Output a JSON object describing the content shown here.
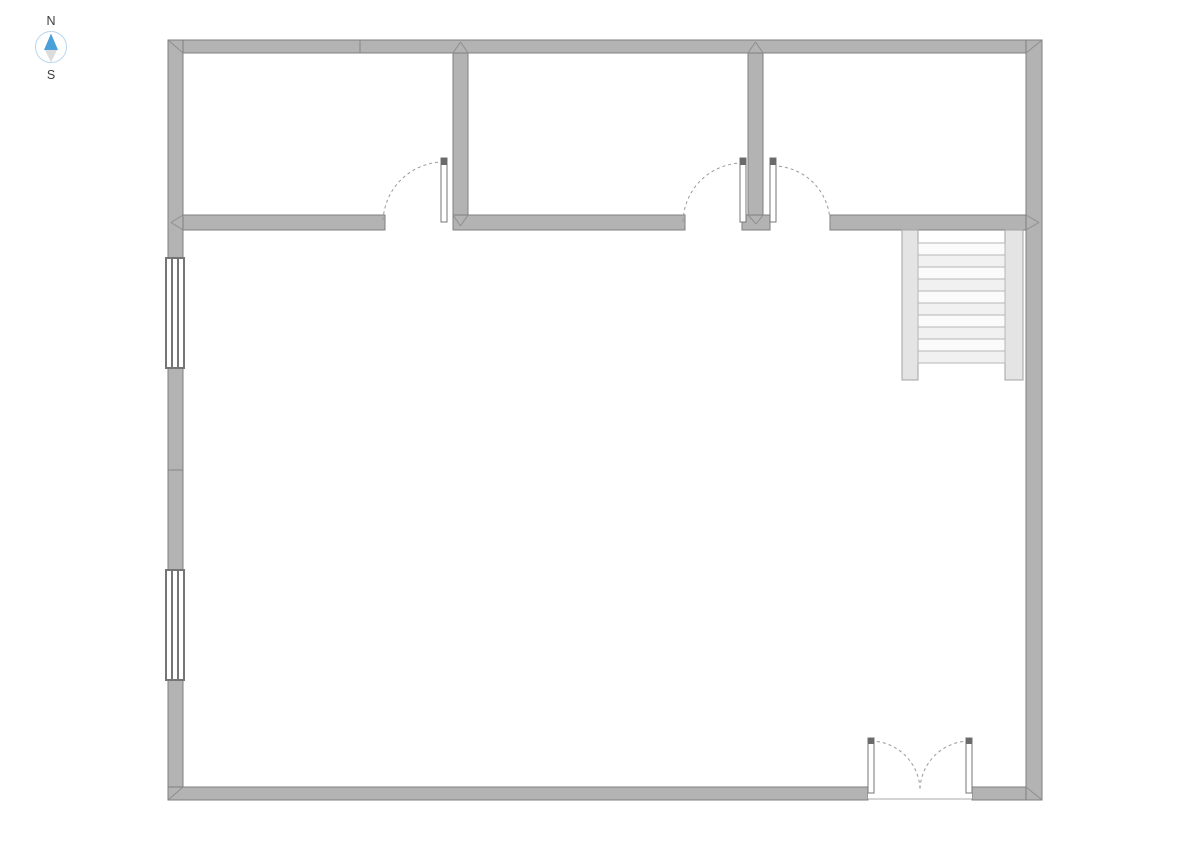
{
  "app": {
    "background_color": "#ffffff"
  },
  "compass": {
    "north_label": "N",
    "south_label": "S",
    "cx": 51,
    "cy": 47,
    "radius": 15.5,
    "ring_color": "#b7d7ec",
    "ring_fill": "#ffffff",
    "north_needle_color": "#4aa0d8",
    "south_needle_color": "#dcdcdc",
    "label_color": "#3c3c3c"
  },
  "floor_plan": {
    "canvas": {
      "width": 1191,
      "height": 842
    },
    "colors": {
      "wall_fill": "#b3b3b3",
      "wall_stroke": "#7f7f7f",
      "miter_stroke": "#8e8e8e",
      "door_leaf_fill": "#ffffff",
      "door_leaf_stroke": "#767676",
      "door_leaf_cap": "#6a6a6a",
      "door_arc": "#9a9a9a",
      "window_fill": "#ffffff",
      "window_stroke": "#757575",
      "stair_stringer_fill": "#e4e4e4",
      "stair_stringer_stroke": "#a3a3a3",
      "stair_tread_fill_a": "#fbfbfb",
      "stair_tread_fill_b": "#f1f1f1",
      "stair_tread_stroke": "#b6b6b6",
      "threshold_fill": "#ffffff",
      "threshold_stroke": "#ababab"
    },
    "walls": [
      {
        "name": "outer-wall-top",
        "x": 168,
        "y": 40,
        "w": 874,
        "h": 13
      },
      {
        "name": "outer-wall-left",
        "x": 168,
        "y": 40,
        "w": 15,
        "h": 760
      },
      {
        "name": "outer-wall-bottom-left",
        "x": 168,
        "y": 787,
        "w": 700,
        "h": 13
      },
      {
        "name": "outer-wall-bottom-right",
        "x": 972,
        "y": 787,
        "w": 70,
        "h": 13
      },
      {
        "name": "outer-wall-right",
        "x": 1026,
        "y": 40,
        "w": 16,
        "h": 760
      },
      {
        "name": "interior-wall-vertical-1",
        "x": 453,
        "y": 53,
        "w": 15,
        "h": 177
      },
      {
        "name": "interior-wall-vertical-2",
        "x": 748,
        "y": 53,
        "w": 15,
        "h": 162
      },
      {
        "name": "interior-wall-pier",
        "x": 742,
        "y": 215,
        "w": 28,
        "h": 15
      },
      {
        "name": "interior-wall-horizontal-left",
        "x": 183,
        "y": 215,
        "w": 202,
        "h": 15
      },
      {
        "name": "interior-wall-horizontal-mid",
        "x": 453,
        "y": 215,
        "w": 232,
        "h": 15
      },
      {
        "name": "interior-wall-horizontal-right",
        "x": 830,
        "y": 215,
        "w": 196,
        "h": 15
      }
    ],
    "miters": [
      [
        168,
        40,
        183,
        53
      ],
      [
        1042,
        40,
        1026,
        53
      ],
      [
        168,
        800,
        183,
        787
      ],
      [
        1042,
        800,
        1026,
        787
      ],
      [
        453,
        53,
        460.5,
        42
      ],
      [
        468,
        53,
        460.5,
        42
      ],
      [
        748,
        53,
        755.5,
        42
      ],
      [
        763,
        53,
        755.5,
        42
      ],
      [
        453,
        215,
        460.5,
        226
      ],
      [
        468,
        215,
        460.5,
        226
      ],
      [
        748,
        215,
        756,
        224
      ],
      [
        763,
        215,
        756,
        224
      ],
      [
        183,
        215,
        171,
        222.5
      ],
      [
        183,
        230,
        171,
        222.5
      ],
      [
        1026,
        215,
        1039,
        222.5
      ],
      [
        1026,
        230,
        1039,
        222.5
      ]
    ],
    "seams": [
      {
        "name": "top-wall-seam",
        "x1": 360,
        "y1": 40.5,
        "x2": 360,
        "y2": 52.5
      },
      {
        "name": "left-wall-seam",
        "x1": 168.5,
        "y1": 470,
        "x2": 182.5,
        "y2": 470
      }
    ],
    "windows": [
      {
        "name": "window-1",
        "x": 166,
        "y": 258,
        "w": 18,
        "h": 110,
        "mullions": 2
      },
      {
        "name": "window-2",
        "x": 166,
        "y": 570,
        "w": 18,
        "h": 110,
        "mullions": 2
      }
    ],
    "doors": [
      {
        "name": "door-room-1",
        "leaf": {
          "x": 441,
          "y": 158,
          "w": 6,
          "h": 64
        },
        "cap_h": 7,
        "arc": "M 444 162 A 61 61 0 0 0 383 223"
      },
      {
        "name": "door-room-2",
        "leaf": {
          "x": 740,
          "y": 158,
          "w": 6,
          "h": 64
        },
        "cap_h": 7,
        "arc": "M 743 163 A 60 60 0 0 0 683 223"
      },
      {
        "name": "door-room-3",
        "leaf": {
          "x": 770,
          "y": 158,
          "w": 6,
          "h": 64
        },
        "cap_h": 7,
        "arc": "M 773 166 A 57 57 0 0 1 830 223"
      },
      {
        "name": "double-door-left-leaf",
        "leaf": {
          "x": 868,
          "y": 738,
          "w": 6,
          "h": 55
        },
        "cap_h": 6,
        "arc": "M 871 741 A 50 50 0 0 1 920 789"
      },
      {
        "name": "double-door-right-leaf",
        "leaf": {
          "x": 966,
          "y": 738,
          "w": 6,
          "h": 55
        },
        "cap_h": 6,
        "arc": "M 969 741 A 50 50 0 0 0 920 789"
      }
    ],
    "threshold": {
      "name": "double-door-threshold",
      "x": 868,
      "y": 787.5,
      "w": 104,
      "h": 12,
      "edge_y": 799
    },
    "stairs": {
      "stringers": [
        {
          "name": "stair-stringer-left",
          "x": 902,
          "y": 230,
          "w": 16,
          "h": 150
        },
        {
          "name": "stair-stringer-right",
          "x": 1005,
          "y": 230,
          "w": 18,
          "h": 150
        }
      ],
      "treads": {
        "x": 918,
        "w": 87,
        "y_start": 243,
        "tread_h": 12,
        "count": 10
      }
    }
  }
}
